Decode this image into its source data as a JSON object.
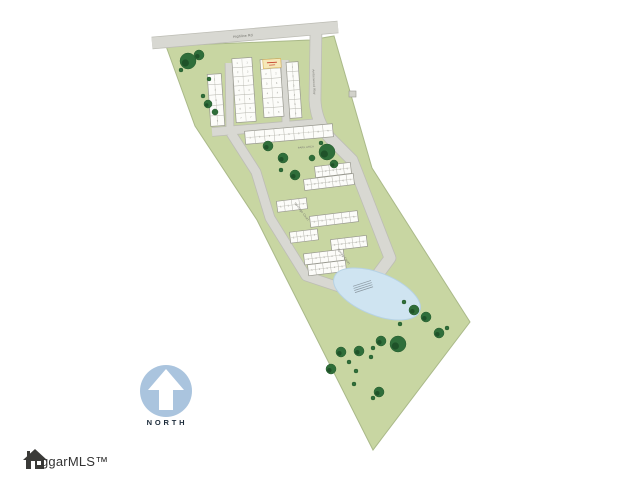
{
  "title": "Residential community site plan",
  "north": {
    "label": "NORTH"
  },
  "logo": {
    "text": "ggarMLS™"
  },
  "colors": {
    "background": "#ffffff",
    "parcel_green": "#c8d6a2",
    "parcel_edge": "#aab989",
    "road_fill": "#d8d8d2",
    "road_casing": "#bdbdb5",
    "building_fill": "#fcfcf9",
    "building_edge": "#98988f",
    "tree_green": "#2f6e3a",
    "tree_dark": "#1f5229",
    "pond_blue": "#cfe4f1",
    "pond_edge": "#b6d2e4",
    "highlight_yellow": "#f6e8b9",
    "highlight_edge": "#d8b254",
    "highlight_mark_red": "#c43c2a",
    "north_circle_blue": "#aac4de",
    "logo_gray": "#333333"
  },
  "map": {
    "parcel": {
      "points": "166,46 310,40 334,36 372,168 470,322 373,450 283,272 257,220 195,126",
      "fill": "#c8d6a2",
      "stroke": "#aab989"
    },
    "roads": [
      {
        "id": "boundary-road-top",
        "path": "M152,43 L338,27",
        "width": 11
      },
      {
        "id": "entrance-drive",
        "path": "M316,30 L315,100 Q316,122 330,138 L352,160 L390,258 L368,288",
        "width": 11
      },
      {
        "id": "cluster-cross-lane",
        "path": "M212,132 L320,123",
        "width": 8
      },
      {
        "id": "cluster-lane-1",
        "path": "M229,63 L230,131",
        "width": 7
      },
      {
        "id": "cluster-lane-2",
        "path": "M285,60 L286,127",
        "width": 7
      },
      {
        "id": "lower-court-loop",
        "path": "M231,133 L256,172 L270,218 L306,276 L339,287 L368,288",
        "width": 9
      }
    ],
    "labels": [
      {
        "id": "top-road-name",
        "text": "Highline Rd",
        "x": 243,
        "y": 37,
        "rot": -5,
        "size": 3.4,
        "color": "#6b6b64"
      },
      {
        "id": "entrance-road-name",
        "text": "Amberwood Way",
        "x": 313,
        "y": 82,
        "rot": 87,
        "size": 3.0,
        "color": "#75756e"
      },
      {
        "id": "court-1-name",
        "text": "Heritage Court",
        "x": 301,
        "y": 212,
        "rot": 53,
        "size": 3.0,
        "color": "#75756e"
      },
      {
        "id": "court-2-name",
        "text": "Spring Court",
        "x": 343,
        "y": 257,
        "rot": 53,
        "size": 3.0,
        "color": "#75756e"
      },
      {
        "id": "park-area-label",
        "text": "PARK AREA",
        "x": 306,
        "y": 148,
        "rot": -5,
        "size": 2.6,
        "color": "#7a7a72"
      }
    ],
    "buildings": [
      {
        "cx": 216,
        "cy": 100,
        "w": 14,
        "h": 52,
        "rot": -4,
        "u": 5
      },
      {
        "cx": 244,
        "cy": 90,
        "w": 20,
        "h": 64,
        "rot": -4,
        "u": 7
      },
      {
        "cx": 272,
        "cy": 88,
        "w": 20,
        "h": 58,
        "rot": -4,
        "u": 6
      },
      {
        "cx": 294,
        "cy": 90,
        "w": 12,
        "h": 56,
        "rot": -4,
        "u": 6
      },
      {
        "cx": 289,
        "cy": 134,
        "w": 88,
        "h": 13,
        "rot": -5,
        "u": 9
      },
      {
        "cx": 333,
        "cy": 170,
        "w": 36,
        "h": 11,
        "rot": -7,
        "u": 5
      },
      {
        "cx": 329,
        "cy": 182,
        "w": 50,
        "h": 11,
        "rot": -7,
        "u": 7
      },
      {
        "cx": 292,
        "cy": 205,
        "w": 30,
        "h": 11,
        "rot": -7,
        "u": 4
      },
      {
        "cx": 334,
        "cy": 219,
        "w": 48,
        "h": 11,
        "rot": -7,
        "u": 6
      },
      {
        "cx": 304,
        "cy": 236,
        "w": 28,
        "h": 11,
        "rot": -7,
        "u": 4
      },
      {
        "cx": 349,
        "cy": 243,
        "w": 36,
        "h": 11,
        "rot": -7,
        "u": 5
      },
      {
        "cx": 324,
        "cy": 257,
        "w": 40,
        "h": 11,
        "rot": -7,
        "u": 5
      },
      {
        "cx": 327,
        "cy": 268,
        "w": 38,
        "h": 11,
        "rot": -7,
        "u": 5
      }
    ],
    "highlight_lot": {
      "cx": 272,
      "cy": 63.5,
      "w": 18,
      "h": 9,
      "rot": -4
    },
    "pond": {
      "cx": 377,
      "cy": 294,
      "rx": 46,
      "ry": 21,
      "rot": 22
    },
    "structures": [
      {
        "x": 349,
        "y": 91,
        "w": 7,
        "h": 6
      }
    ],
    "trees": [
      [
        188,
        61,
        8
      ],
      [
        199,
        55,
        5
      ],
      [
        181,
        70,
        2
      ],
      [
        209,
        79,
        2
      ],
      [
        203,
        96,
        2
      ],
      [
        208,
        104,
        4
      ],
      [
        215,
        112,
        3
      ],
      [
        268,
        146,
        5
      ],
      [
        283,
        158,
        5
      ],
      [
        281,
        170,
        2
      ],
      [
        295,
        175,
        5
      ],
      [
        312,
        158,
        3
      ],
      [
        327,
        152,
        8
      ],
      [
        334,
        164,
        4
      ],
      [
        321,
        143,
        2
      ],
      [
        404,
        302,
        2
      ],
      [
        414,
        310,
        5
      ],
      [
        426,
        317,
        5
      ],
      [
        400,
        324,
        2
      ],
      [
        439,
        333,
        5
      ],
      [
        447,
        328,
        2
      ],
      [
        398,
        344,
        8
      ],
      [
        381,
        341,
        5
      ],
      [
        373,
        348,
        2
      ],
      [
        359,
        351,
        5
      ],
      [
        341,
        352,
        5
      ],
      [
        371,
        357,
        2
      ],
      [
        349,
        362,
        2
      ],
      [
        331,
        369,
        5
      ],
      [
        356,
        371,
        2
      ],
      [
        354,
        384,
        2
      ],
      [
        379,
        392,
        5
      ],
      [
        373,
        398,
        2
      ]
    ]
  }
}
